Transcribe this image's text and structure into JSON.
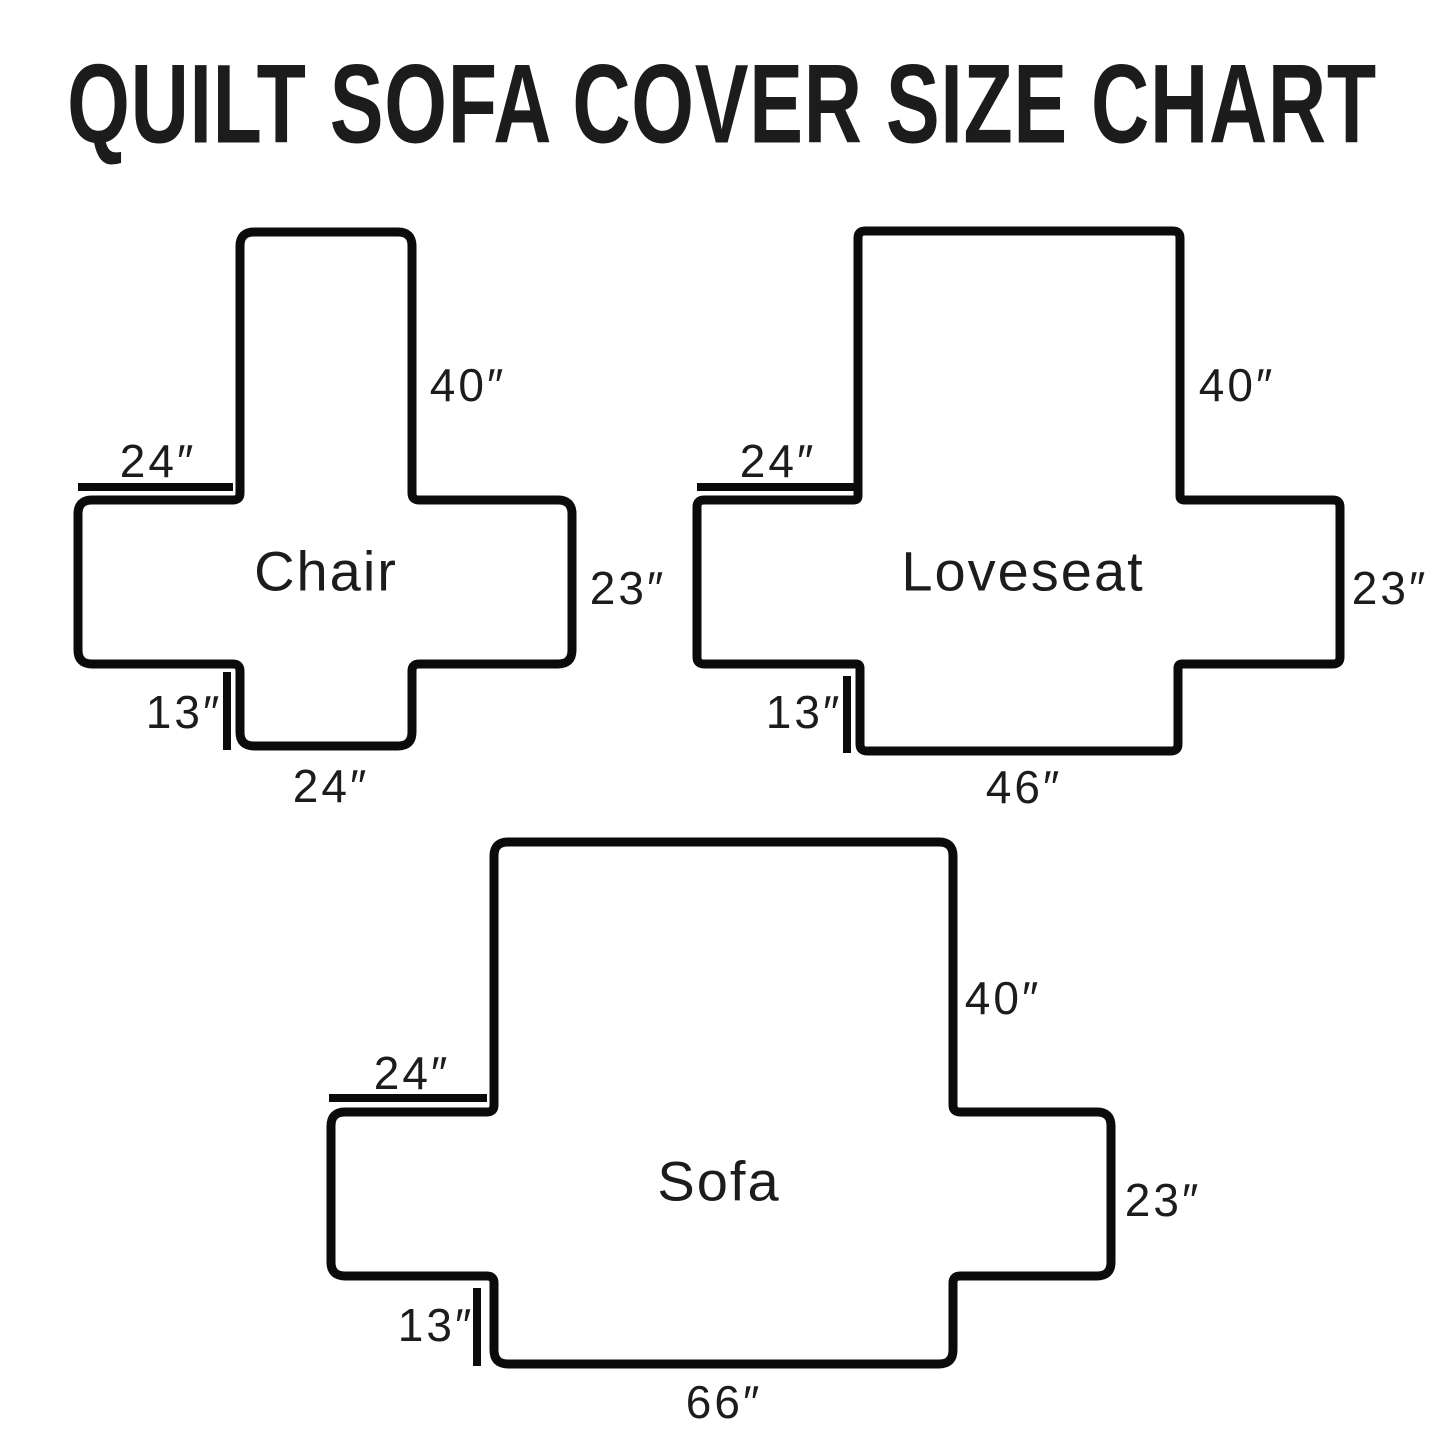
{
  "title": "QUILT SOFA COVER SIZE CHART",
  "colors": {
    "outline": "#0b0b0b",
    "text": "#1c1c1c",
    "background": "#ffffff"
  },
  "diagrams": [
    {
      "id": "chair",
      "name": "Chair",
      "dims": {
        "back_height": "40″",
        "arm_top_width": "24″",
        "side_depth": "23″",
        "skirt_drop": "13″",
        "seat_width": "24″"
      }
    },
    {
      "id": "loveseat",
      "name": "Loveseat",
      "dims": {
        "back_height": "40″",
        "arm_top_width": "24″",
        "side_depth": "23″",
        "skirt_drop": "13″",
        "seat_width": "46″"
      }
    },
    {
      "id": "sofa",
      "name": "Sofa",
      "dims": {
        "back_height": "40″",
        "arm_top_width": "24″",
        "side_depth": "23″",
        "skirt_drop": "13″",
        "seat_width": "66″"
      }
    }
  ]
}
